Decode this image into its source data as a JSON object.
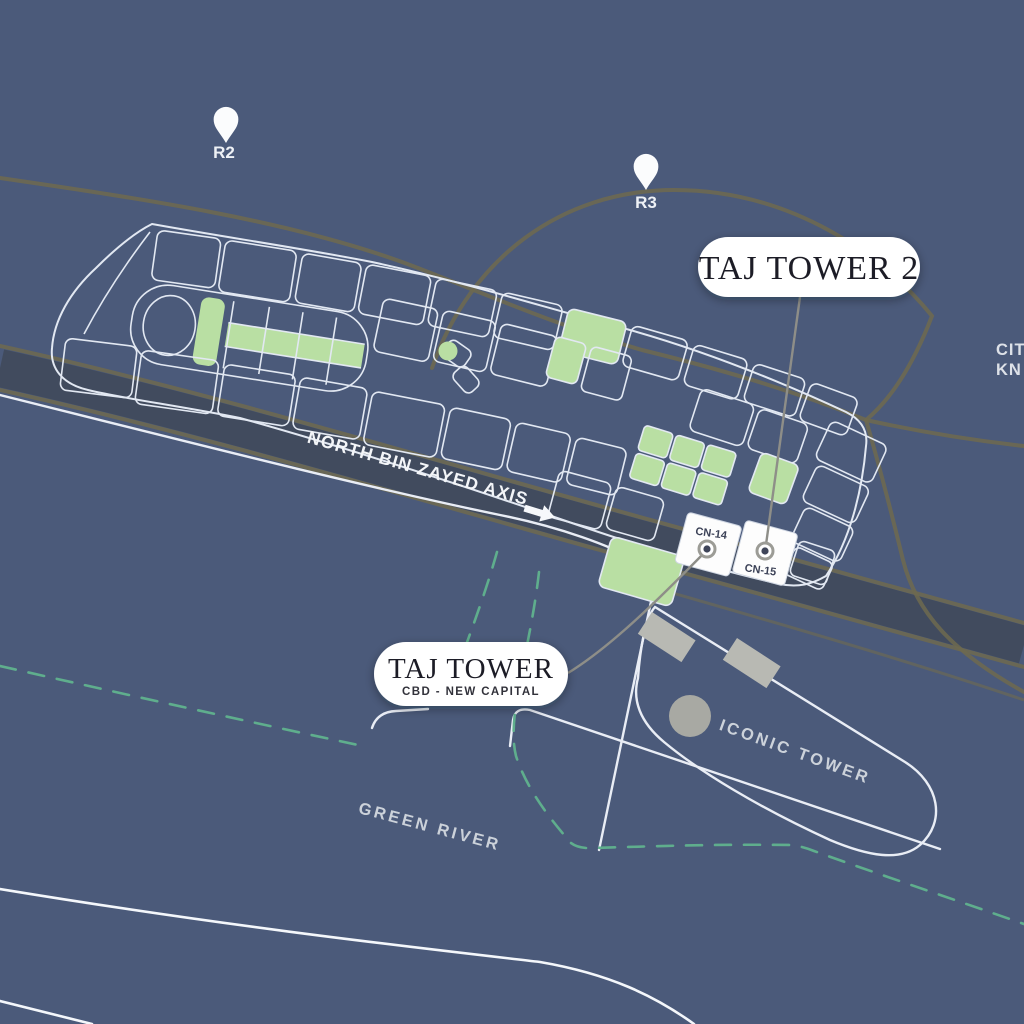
{
  "map": {
    "pins": {
      "r2": "R2",
      "r3": "R3"
    },
    "primary_label": {
      "title": "TAJ TOWER 2"
    },
    "secondary_label": {
      "title": "TAJ TOWER",
      "subtitle": "CBD - NEW CAPITAL"
    },
    "roads": {
      "axis": "NORTH BIN ZAYED AXIS"
    },
    "landmarks": {
      "iconic_tower": "ICONIC TOWER",
      "green_river": "GREEN RIVER",
      "city_partial_line1": "CIT",
      "city_partial_line2": "KN"
    },
    "plots": {
      "cn14": "CN-14",
      "cn15": "CN-15"
    },
    "colors": {
      "bg": "#4b5a7a",
      "parcel_stroke": "#e2e8f2",
      "green_fill": "#b9dfa3",
      "road_olive": "#6f6a4f",
      "road_white": "#e9edf5",
      "dashed_green": "#5fae8d",
      "gray_fill": "#b8b9b3",
      "leader_gray": "#8e8e88",
      "pill_bg": "#ffffff",
      "pill_text": "#1f1f27",
      "light_label": "#ccd2da",
      "dot_center": "#3f4559"
    }
  }
}
